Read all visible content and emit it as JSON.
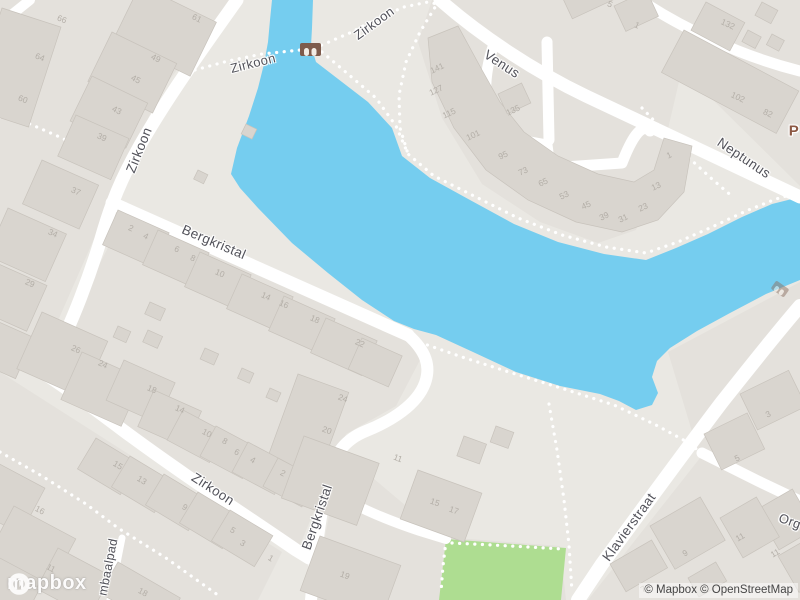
{
  "map": {
    "attribution": "© Mapbox © OpenStreetMap",
    "logo_text": "mapbox",
    "streets": {
      "zirkoon_nw": "Zirkoon",
      "zirkoon_path_mid": "Zirkoon",
      "zirkoon_path_upper": "Zirkoon",
      "zirkoon_south": "Zirkoon",
      "venus": "Venus",
      "neptunus": "Neptunus",
      "bergkristal_main": "Bergkristal",
      "bergkristal_south": "Bergkristal",
      "klavierstraat": "Klavierstraat",
      "mbaalpad_partial": "mbaalpad",
      "org_partial": "Org",
      "place_partial": "P"
    },
    "icons": {
      "bridge": "arch-bridge-icon",
      "logo": "mapbox-logo-icon"
    },
    "colors": {
      "water": "#75cdef",
      "park": "#aedd91",
      "road": "#ffffff",
      "land": "#eae8e3",
      "block": "#e4e1dc",
      "building": "#d9d5cf",
      "street_label": "#52525a",
      "house_number": "#b3aea7",
      "place_label": "#8b5742",
      "bridge": "#7d5b4c"
    },
    "house_numbers": [
      {
        "t": "66",
        "x": 62,
        "y": 19,
        "r": 22
      },
      {
        "t": "64",
        "x": 40,
        "y": 57,
        "r": 22
      },
      {
        "t": "60",
        "x": 23,
        "y": 99,
        "r": 22
      },
      {
        "t": "61",
        "x": 197,
        "y": 18,
        "r": 26
      },
      {
        "t": "49",
        "x": 156,
        "y": 58,
        "r": 26
      },
      {
        "t": "45",
        "x": 136,
        "y": 79,
        "r": 26
      },
      {
        "t": "43",
        "x": 117,
        "y": 110,
        "r": 26
      },
      {
        "t": "39",
        "x": 102,
        "y": 137,
        "r": 24
      },
      {
        "t": "37",
        "x": 76,
        "y": 191,
        "r": 24
      },
      {
        "t": "34",
        "x": 53,
        "y": 233,
        "r": 24
      },
      {
        "t": "29",
        "x": 30,
        "y": 283,
        "r": 24
      },
      {
        "t": "26",
        "x": 76,
        "y": 349,
        "r": 24
      },
      {
        "t": "24",
        "x": 103,
        "y": 364,
        "r": 24
      },
      {
        "t": "141",
        "x": 437,
        "y": 68,
        "r": -25
      },
      {
        "t": "127",
        "x": 436,
        "y": 90,
        "r": -25
      },
      {
        "t": "115",
        "x": 449,
        "y": 113,
        "r": -25
      },
      {
        "t": "101",
        "x": 473,
        "y": 135,
        "r": -25
      },
      {
        "t": "95",
        "x": 503,
        "y": 155,
        "r": -25
      },
      {
        "t": "73",
        "x": 523,
        "y": 171,
        "r": -25
      },
      {
        "t": "65",
        "x": 543,
        "y": 182,
        "r": -25
      },
      {
        "t": "53",
        "x": 564,
        "y": 195,
        "r": -25
      },
      {
        "t": "45",
        "x": 586,
        "y": 205,
        "r": -25
      },
      {
        "t": "39",
        "x": 604,
        "y": 216,
        "r": -25
      },
      {
        "t": "31",
        "x": 623,
        "y": 218,
        "r": -25
      },
      {
        "t": "23",
        "x": 643,
        "y": 207,
        "r": -25
      },
      {
        "t": "13",
        "x": 656,
        "y": 186,
        "r": -25
      },
      {
        "t": "1",
        "x": 669,
        "y": 155,
        "r": -25
      },
      {
        "t": "135",
        "x": 513,
        "y": 110,
        "r": -25
      },
      {
        "t": "5",
        "x": 610,
        "y": 4,
        "r": 25
      },
      {
        "t": "1",
        "x": 637,
        "y": 25,
        "r": 25
      },
      {
        "t": "132",
        "x": 728,
        "y": 24,
        "r": 25
      },
      {
        "t": "102",
        "x": 738,
        "y": 97,
        "r": 25
      },
      {
        "t": "82",
        "x": 768,
        "y": 113,
        "r": 25
      },
      {
        "t": "2",
        "x": 131,
        "y": 228,
        "r": 24
      },
      {
        "t": "4",
        "x": 146,
        "y": 236,
        "r": 24
      },
      {
        "t": "6",
        "x": 177,
        "y": 249,
        "r": 24
      },
      {
        "t": "8",
        "x": 193,
        "y": 258,
        "r": 24
      },
      {
        "t": "10",
        "x": 220,
        "y": 273,
        "r": 24
      },
      {
        "t": "14",
        "x": 266,
        "y": 296,
        "r": 24
      },
      {
        "t": "16",
        "x": 284,
        "y": 304,
        "r": 24
      },
      {
        "t": "18",
        "x": 315,
        "y": 319,
        "r": 24
      },
      {
        "t": "22",
        "x": 360,
        "y": 343,
        "r": 24
      },
      {
        "t": "18",
        "x": 152,
        "y": 389,
        "r": 24
      },
      {
        "t": "14",
        "x": 180,
        "y": 409,
        "r": 24
      },
      {
        "t": "24",
        "x": 343,
        "y": 398,
        "r": 20
      },
      {
        "t": "20",
        "x": 327,
        "y": 430,
        "r": 20
      },
      {
        "t": "10",
        "x": 207,
        "y": 433,
        "r": 28
      },
      {
        "t": "8",
        "x": 225,
        "y": 441,
        "r": 28
      },
      {
        "t": "6",
        "x": 237,
        "y": 452,
        "r": 28
      },
      {
        "t": "4",
        "x": 253,
        "y": 460,
        "r": 28
      },
      {
        "t": "2",
        "x": 283,
        "y": 473,
        "r": 28
      },
      {
        "t": "15",
        "x": 118,
        "y": 465,
        "r": 31
      },
      {
        "t": "13",
        "x": 142,
        "y": 480,
        "r": 31
      },
      {
        "t": "9",
        "x": 185,
        "y": 507,
        "r": 31
      },
      {
        "t": "5",
        "x": 233,
        "y": 530,
        "r": 31
      },
      {
        "t": "3",
        "x": 243,
        "y": 543,
        "r": 31
      },
      {
        "t": "1",
        "x": 271,
        "y": 558,
        "r": 31
      },
      {
        "t": "16",
        "x": 40,
        "y": 510,
        "r": 28
      },
      {
        "t": "11",
        "x": 51,
        "y": 568,
        "r": 28
      },
      {
        "t": "18",
        "x": 143,
        "y": 592,
        "r": 28
      },
      {
        "t": "11",
        "x": 398,
        "y": 458,
        "r": 20
      },
      {
        "t": "15",
        "x": 435,
        "y": 502,
        "r": 20
      },
      {
        "t": "17",
        "x": 454,
        "y": 510,
        "r": 20
      },
      {
        "t": "19",
        "x": 345,
        "y": 575,
        "r": 20
      },
      {
        "t": "3",
        "x": 768,
        "y": 414,
        "r": -26
      },
      {
        "t": "5",
        "x": 737,
        "y": 458,
        "r": -26
      },
      {
        "t": "9",
        "x": 685,
        "y": 553,
        "r": -30
      },
      {
        "t": "11",
        "x": 740,
        "y": 537,
        "r": -30
      },
      {
        "t": "11",
        "x": 775,
        "y": 553,
        "r": -30
      },
      {
        "t": "7",
        "x": 643,
        "y": 589,
        "r": -30
      }
    ]
  }
}
